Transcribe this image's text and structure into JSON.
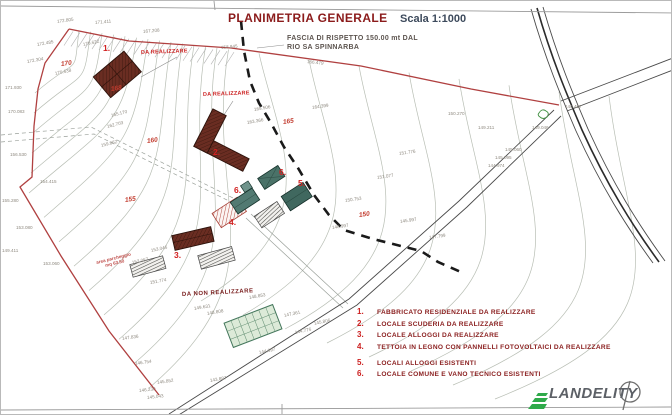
{
  "title": {
    "main": "PLANIMETRIA GENERALE",
    "scale": "Scala 1:1000"
  },
  "annotations": {
    "fascia_line1": "FASCIA DI RISPETTO 150.00 mt DAL",
    "fascia_line2": "RIO SA SPINNARBA",
    "da_realizzare_top": "DA REALIZZARE",
    "da_realizzare_mid": "DA REALIZZARE",
    "da_non_realizzare": "DA NON REALIZZARE",
    "area_parcheggio_1": "area parcheggio",
    "area_parcheggio_2": "mq 63.50"
  },
  "legend": {
    "items": [
      {
        "num": "1.",
        "label": "FABBRICATO RESIDENZIALE DA REALIZZARE"
      },
      {
        "num": "2.",
        "label": "LOCALE SCUDERIA DA REALIZZARE"
      },
      {
        "num": "3.",
        "label": "LOCALE ALLOGGI DA REALIZZARE"
      },
      {
        "num": "4.",
        "label": "TETTOIA IN LEGNO CON PANNELLI FOTOVOLTAICI DA REALIZZARE"
      },
      {
        "num": "5.",
        "label": "LOCALI ALLOGGI ESISTENTI"
      },
      {
        "num": "6.",
        "label": "LOCALE COMUNE E VANO TECNICO ESISTENTI"
      }
    ]
  },
  "map": {
    "building_markers": [
      {
        "num": "1.",
        "x": 102,
        "y": 42
      },
      {
        "num": "2.",
        "x": 212,
        "y": 146
      },
      {
        "num": "3.",
        "x": 173,
        "y": 249
      },
      {
        "num": "4.",
        "x": 228,
        "y": 216
      },
      {
        "num": "5.",
        "x": 297,
        "y": 177
      },
      {
        "num": "6.",
        "x": 278,
        "y": 166
      },
      {
        "num": "6.",
        "x": 233,
        "y": 184
      }
    ],
    "index_contours": [
      {
        "label": "170",
        "x": 60,
        "y": 60
      },
      {
        "label": "168",
        "x": 110,
        "y": 85
      },
      {
        "label": "165",
        "x": 282,
        "y": 118
      },
      {
        "label": "160",
        "x": 146,
        "y": 137
      },
      {
        "label": "155",
        "x": 124,
        "y": 196
      },
      {
        "label": "150",
        "x": 358,
        "y": 211
      }
    ],
    "spot_elevations": [
      {
        "t": "172.805",
        "x": 56,
        "y": 18,
        "r": -8
      },
      {
        "t": "171.411",
        "x": 94,
        "y": 19,
        "r": -5
      },
      {
        "t": "167.208",
        "x": 142,
        "y": 28,
        "r": -5
      },
      {
        "t": "172.485",
        "x": 36,
        "y": 41,
        "r": -10
      },
      {
        "t": "172.304",
        "x": 26,
        "y": 58,
        "r": -10
      },
      {
        "t": "170.622",
        "x": 82,
        "y": 41,
        "r": -12
      },
      {
        "t": "170.638",
        "x": 54,
        "y": 70,
        "r": -12
      },
      {
        "t": "171.930",
        "x": 4,
        "y": 84,
        "r": 0
      },
      {
        "t": "170.083",
        "x": 7,
        "y": 108,
        "r": 0
      },
      {
        "t": "156.530",
        "x": 9,
        "y": 151,
        "r": 0
      },
      {
        "t": "154.415",
        "x": 39,
        "y": 178,
        "r": 0
      },
      {
        "t": "155.280",
        "x": 1,
        "y": 197,
        "r": 0
      },
      {
        "t": "153.080",
        "x": 15,
        "y": 224,
        "r": 0
      },
      {
        "t": "153.060",
        "x": 42,
        "y": 260,
        "r": 0
      },
      {
        "t": "149.411",
        "x": 1,
        "y": 247,
        "r": 0
      },
      {
        "t": "158.945",
        "x": 220,
        "y": 44,
        "r": -5
      },
      {
        "t": "166.479",
        "x": 306,
        "y": 58,
        "r": 6
      },
      {
        "t": "165.506",
        "x": 253,
        "y": 106,
        "r": -10
      },
      {
        "t": "163.366",
        "x": 246,
        "y": 119,
        "r": -10
      },
      {
        "t": "164.399",
        "x": 311,
        "y": 104,
        "r": -8
      },
      {
        "t": "165.170",
        "x": 110,
        "y": 112,
        "r": -14
      },
      {
        "t": "162.703",
        "x": 106,
        "y": 123,
        "r": -14
      },
      {
        "t": "159.862",
        "x": 100,
        "y": 142,
        "r": -14
      },
      {
        "t": "153.046",
        "x": 150,
        "y": 247,
        "r": -12
      },
      {
        "t": "152.057",
        "x": 131,
        "y": 259,
        "r": -12
      },
      {
        "t": "151.774",
        "x": 149,
        "y": 279,
        "r": -10
      },
      {
        "t": "149.631",
        "x": 193,
        "y": 305,
        "r": -10
      },
      {
        "t": "151.776",
        "x": 398,
        "y": 150,
        "r": -8
      },
      {
        "t": "151.077",
        "x": 376,
        "y": 174,
        "r": -8
      },
      {
        "t": "150.753",
        "x": 344,
        "y": 197,
        "r": -8
      },
      {
        "t": "145.997",
        "x": 399,
        "y": 218,
        "r": -8
      },
      {
        "t": "148.997",
        "x": 331,
        "y": 224,
        "r": -8
      },
      {
        "t": "147.799",
        "x": 428,
        "y": 234,
        "r": -8
      },
      {
        "t": "150.270",
        "x": 447,
        "y": 110,
        "r": 0
      },
      {
        "t": "149.211",
        "x": 477,
        "y": 124,
        "r": 0
      },
      {
        "t": "149.046",
        "x": 531,
        "y": 124,
        "r": 0
      },
      {
        "t": "145.060",
        "x": 504,
        "y": 146,
        "r": 0
      },
      {
        "t": "145.095",
        "x": 494,
        "y": 154,
        "r": 0
      },
      {
        "t": "144.974",
        "x": 487,
        "y": 162,
        "r": 0
      },
      {
        "t": "140.457",
        "x": 564,
        "y": 103,
        "r": 0
      },
      {
        "t": "148.853",
        "x": 248,
        "y": 294,
        "r": -10
      },
      {
        "t": "148.808",
        "x": 206,
        "y": 310,
        "r": -10
      },
      {
        "t": "147.361",
        "x": 283,
        "y": 312,
        "r": -12
      },
      {
        "t": "145.806",
        "x": 313,
        "y": 320,
        "r": -12
      },
      {
        "t": "144.776",
        "x": 294,
        "y": 329,
        "r": -12
      },
      {
        "t": "144.697",
        "x": 258,
        "y": 349,
        "r": -12
      },
      {
        "t": "143.887",
        "x": 209,
        "y": 377,
        "r": -10
      },
      {
        "t": "147.836",
        "x": 121,
        "y": 335,
        "r": -8
      },
      {
        "t": "146.754",
        "x": 134,
        "y": 360,
        "r": -8
      },
      {
        "t": "145.852",
        "x": 156,
        "y": 379,
        "r": -8
      },
      {
        "t": "146.230",
        "x": 138,
        "y": 387,
        "r": -6
      },
      {
        "t": "145.043",
        "x": 146,
        "y": 394,
        "r": -6
      }
    ]
  },
  "logo": {
    "name": "LANDELITY"
  },
  "colors": {
    "boundary": "#b04040",
    "title": "#8b1b1b",
    "legend_number": "#cc1f1f",
    "legend_text": "#8b2020",
    "buffer_line": "#1a1a1a",
    "building_new_red": "#6a2d22",
    "building_existing_teal": "#4a7268",
    "greenhouse_green": "#dcead8",
    "logo_green": "#2faa4a",
    "contour_grey": "#b8beb4"
  }
}
